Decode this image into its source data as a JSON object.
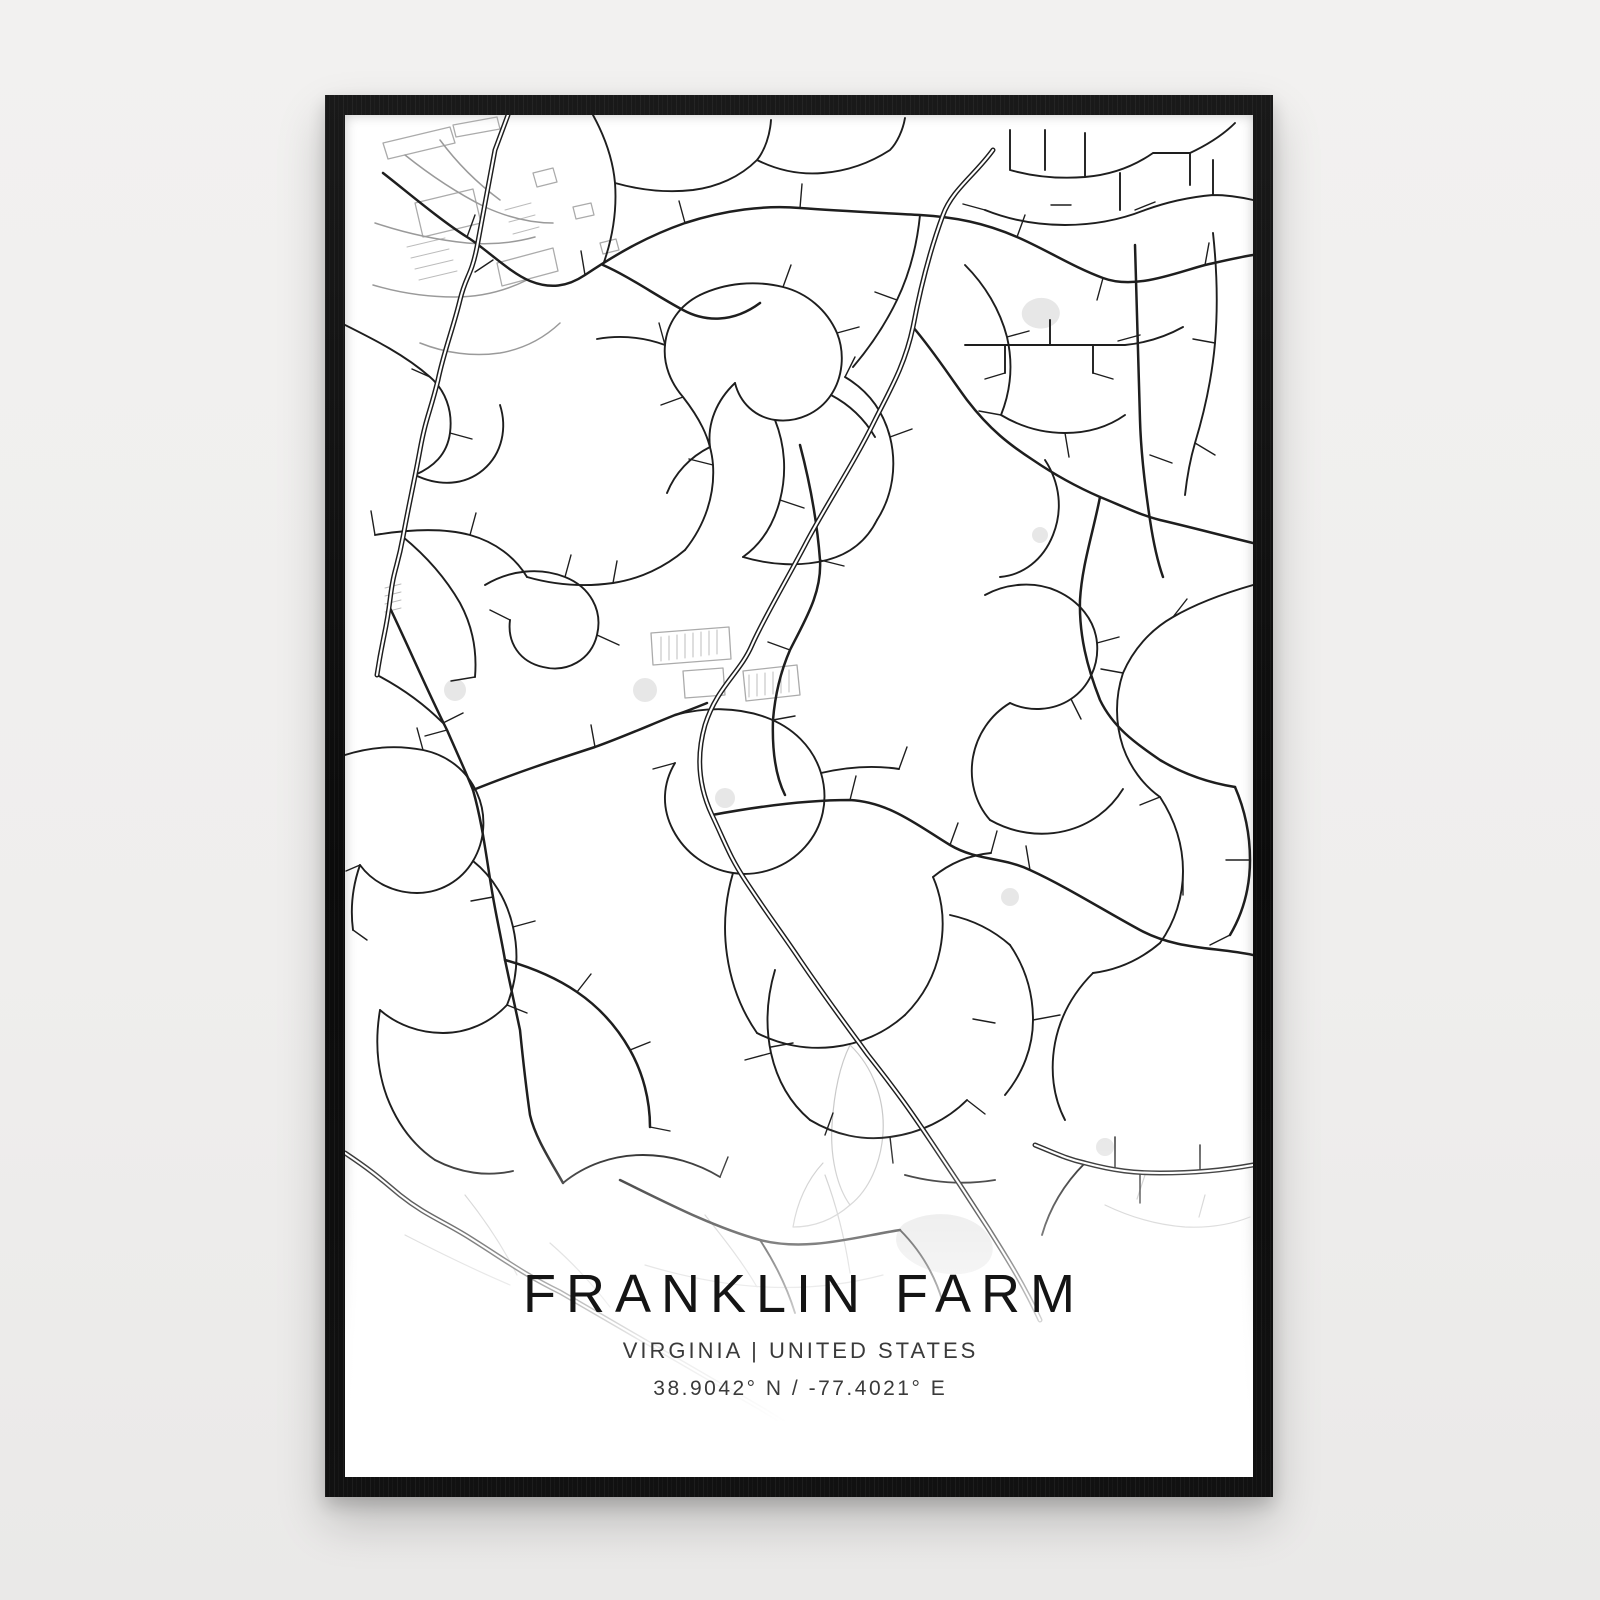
{
  "page": {
    "wall_color": "#f0efee"
  },
  "poster": {
    "title": "FRANKLIN FARM",
    "subtitle": "VIRGINIA | UNITED STATES",
    "coordinates": "38.9042° N / -77.4021° E",
    "frame_color": "#111111",
    "paper_color": "#ffffff"
  },
  "map": {
    "viewbox": "0 0 908 1362",
    "colors": {
      "road": "#1e1e1e",
      "casing_inner": "#ffffff",
      "commercial": "#9a9a9a",
      "building": "#ababab",
      "hatch": "#bcbcbc",
      "trail": "#c9c9c9",
      "pond": "#e7e7e7"
    },
    "major_roads": [
      "M648,35 C630,60 607,75 598,100 C585,135 575,175 568,212 C560,250 545,275 530,305 C508,350 478,395 460,430 C440,468 418,505 407,530 C395,558 372,572 360,610 C352,638 352,668 367,700 C382,732 385,742 400,765 C425,803 437,818 455,845 C487,892 505,915 523,940 C553,978 567,998 585,1025 C610,1062 625,1085 643,1113 C660,1140 678,1168 695,1205",
      "M163,0 L150,35 C144,66 138,100 132,132 C126,162 121,160 115,185 C108,214 99,236 93,265 C85,298 81,302 75,335 C69,368 64,389 58,422 C52,455 49,452 45,485 C41,518 38,520 32,560",
      "M0,1038 C30,1058 38,1066 55,1080 C80,1100 98,1106 125,1123 C160,1145 180,1160 215,1177 C250,1197 280,1215 315,1235 C350,1255 380,1273 415,1293 C437,1306 455,1318 478,1333",
      "M690,1030 C710,1038 722,1044 740,1048 C770,1056 790,1058 815,1058 C845,1058 875,1056 908,1050"
    ],
    "collector_roads": [
      "M38,58 C60,75 95,105 122,122 C140,133 165,158 185,166 C205,174 222,172 240,160 C270,140 300,122 340,108 C380,95 420,90 455,93 C495,96 540,98 575,100 C610,102 640,108 672,122 C700,134 728,152 758,163 C790,175 830,158 860,150 C878,146 895,142 908,140",
      "M568,212 C590,238 605,262 622,285 C645,315 665,330 688,345 C710,360 732,372 755,382 C775,390 795,400 815,405 C845,412 875,420 908,428",
      "M45,493 C65,535 82,575 102,615 C112,638 120,655 128,675 C138,710 142,748 148,782 C152,805 156,822 160,845 C165,868 170,892 175,915 C178,945 181,972 185,1000 C190,1022 205,1045 218,1068",
      "M128,675 C170,658 210,645 250,632 C278,622 305,610 330,600 C340,597 352,592 362,588",
      "M367,700 C410,692 460,685 505,685 C545,687 575,712 605,730 C632,746 658,742 685,755 C722,772 758,795 795,815 C832,835 870,832 908,840",
      "M455,330 C465,368 472,405 475,445 C477,478 460,505 445,535 C435,558 430,580 428,605 C427,635 430,660 440,680",
      "M755,382 C748,418 737,450 735,485 C734,520 742,552 755,585 C768,612 790,628 815,645 C840,660 865,668 890,672",
      "M790,130 C792,190 793,245 795,305 C796,340 800,372 805,405 C808,425 812,445 818,462",
      "M258,150 C285,162 310,180 338,195 C360,207 388,208 415,188",
      "M275,1065 C322,1088 368,1112 415,1125 C462,1137 510,1122 555,1115",
      "M160,845 C185,852 210,862 232,877 C254,892 272,912 285,935 C298,958 305,985 305,1012",
      "M890,672 C900,695 905,720 905,745 C905,772 898,798 885,820"
    ],
    "local_roads": [
      "M0,210 C30,225 60,240 85,262 C100,275 108,295 105,318 C102,340 88,352 70,360",
      "M70,360 C95,372 120,370 138,355 C158,338 162,312 155,290",
      "M30,420 C60,415 95,412 125,420 C150,427 170,442 182,462",
      "M58,422 C80,440 100,462 115,488 C128,512 132,538 130,562",
      "M140,470 C165,455 195,452 220,462 C245,472 258,495 252,520 C246,545 222,558 198,552 C175,547 162,528 165,505",
      "M182,462 C210,470 240,472 268,468 C295,464 320,452 340,435",
      "M340,435 C360,410 370,380 368,350 C366,322 352,300 338,282 C326,268 318,250 320,230 C322,208 335,190 355,180",
      "M355,180 C380,168 410,165 438,172 C462,178 482,195 492,218 C500,238 498,262 486,280 C474,298 452,308 430,305 C410,302 395,288 390,268",
      "M390,268 C372,285 362,308 365,332",
      "M430,305 C440,330 442,358 435,385 C428,412 415,430 398,442",
      "M398,442 C425,450 455,452 482,445 C505,439 522,425 532,405",
      "M532,405 C548,380 552,350 545,322 C538,295 522,275 500,262",
      "M320,230 C298,222 275,220 252,224 M486,280 C505,290 520,305 530,322 M365,332 C345,342 330,358 322,378",
      "M258,150 C268,122 272,95 270,68 C268,45 260,22 248,0 M270,68 C295,75 322,78 348,75 M348,75 C372,72 395,62 412,45 C420,35 425,20 426,5 M412,45 C432,55 455,60 478,58 M478,58 C502,56 525,48 545,35 C552,28 558,15 560,3",
      "M575,100 C572,130 565,158 552,185 C540,210 525,232 508,252",
      "M620,150 C640,170 655,195 662,222 M662,222 C668,248 666,275 656,300 M656,300 C676,312 698,318 720,318 M720,318 C742,318 763,312 780,300",
      "M665,15 L665,55 M665,55 C690,62 715,64 740,62 M740,62 L740,18 M740,62 C765,60 788,52 808,38 M700,55 L700,15 M775,58 L775,95 M808,38 L845,38 M845,38 L845,70 M845,38 C862,30 878,20 890,8",
      "M640,95 C665,105 692,110 720,110 C748,110 775,105 800,95 M800,95 C822,87 845,82 868,80 M868,80 L868,45 M868,80 C882,80 895,82 908,85",
      "M868,118 C872,155 873,192 870,228 C867,262 860,295 850,328 M850,328 C845,345 842,362 840,380",
      "M620,230 L780,230 M660,230 L660,258 M705,230 L705,205 M748,230 L748,258 M780,230 C800,228 820,222 838,212",
      "M700,345 C715,368 718,395 708,420 C698,445 678,460 655,462",
      "M908,470 C880,478 852,488 828,502 C805,515 788,535 778,558",
      "M778,558 C770,582 770,608 778,632 C785,652 798,670 815,682",
      "M640,480 C662,468 690,466 712,476 C734,486 750,505 752,528 C754,550 744,572 726,584 C708,596 684,597 665,588",
      "M665,588 C645,600 632,620 628,642 C624,665 630,688 645,705",
      "M645,705 C668,718 695,722 720,716 M720,716 C745,710 765,695 778,674",
      "M330,600 C360,592 392,592 420,602 C448,612 468,632 476,658 C484,685 478,712 460,732 C442,752 415,762 388,758 C362,754 340,738 328,715 C316,692 318,668 330,648",
      "M476,658 C502,652 528,650 554,654",
      "M388,758 C380,785 378,812 382,840 C386,868 396,895 412,918",
      "M412,918 C435,930 462,935 488,932 C515,929 540,918 560,900",
      "M560,900 C578,882 590,860 595,835 C600,810 598,785 588,762",
      "M588,762 C605,748 625,740 646,738",
      "M32,560 C55,572 78,588 98,608",
      "M0,640 C25,632 52,630 78,635 C102,640 122,655 132,678 C142,700 140,726 128,746 C116,766 95,778 72,778 C50,778 28,768 15,750",
      "M15,750 C8,770 5,792 8,815",
      "M128,746 C148,762 162,785 168,812 C174,838 172,865 162,890",
      "M162,890 C145,908 122,918 98,918 C75,918 52,910 35,895",
      "M35,895 C30,925 32,955 42,982 C52,1008 68,1030 90,1045",
      "M90,1045 C115,1058 142,1062 168,1056",
      "M218,1068 C240,1050 268,1040 298,1040",
      "M298,1040 C325,1040 352,1048 375,1062",
      "M430,855 C422,882 420,910 426,938 C432,965 445,988 465,1005",
      "M465,1005 C490,1020 518,1026 545,1022",
      "M545,1022 C575,1018 602,1005 622,985",
      "M660,980 C678,958 688,932 688,905 C688,878 680,852 665,830",
      "M665,830 C648,815 628,805 605,800",
      "M740,1048 C720,1068 705,1092 697,1120",
      "M815,682 C830,705 838,730 838,756 C838,782 830,807 815,828",
      "M815,828 C795,845 772,855 748,858",
      "M748,858 C728,878 715,902 710,928 C705,955 708,982 720,1005",
      "M560,1060 C590,1068 620,1070 650,1065 M415,1125 C430,1148 442,1172 450,1198 M555,1115 C575,1135 590,1160 598,1188"
    ],
    "stub_roads": [
      "M85,262 l-18,-8 M105,318 l22,6 M130,562 l-24,4 M165,505 l-20,-10 M252,520 l22,10 M220,462 l6,-22 M268,468 l4,-22 M30,420 l-4,-24 M125,420 l6,-22",
      "M368,350 l-24,-6 M338,282 l-22,8 M438,172 l8,-22 M492,218 l22,-6 M435,385 l24,8 M500,262 l10,-20 M545,322 l22,-8 M552,185 l-22,-8 M320,230 l-6,-22",
      "M726,90 l-20,0 M790,95 l20,-8 M795,220 l-22,6 M805,340 l22,8 M850,328 l20,12 M660,258 l-20,6 M748,258 l20,6 M870,228 l-22,-4 M640,95 l-22,-6",
      "M475,445 l24,6 M445,535 l-22,-8 M505,685 l6,-24 M605,730 l8,-22 M685,755 l-4,-24 M330,648 l-22,6 M554,654 l8,-22 M646,738 l6,-22",
      "M78,635 l-6,-22 M15,750 l-14,6 M168,812 l22,-6 M98,608 l20,-10 M8,815 l14,10 M162,890 l20,8",
      "M232,877 l14,-18 M285,935 l20,-8 M305,1012 l20,4 M375,1062 l8,-20 M448,928 l-22,4 M488,998 l-8,22 M622,985 l18,14 M650,908 l-22,-4",
      "M828,502 l14,-18 M778,558 l-22,-4 M838,756 l0,24 M885,820 l-20,10 M905,745 l-24,0 M815,682 l-20,8 M752,528 l22,-6 M726,584 l10,20",
      "M122,122 l8,-22 M240,160 l-4,-24 M340,108 l-6,-22 M455,93 l2,-24 M672,122 l8,-22 M758,163 l-6,22 M860,150 l4,-22 M148,145 l-18,12 M102,615 l-22,6 M148,782 l-22,4 M250,632 l-4,-22 M428,605 l22,-4",
      "M795,1057 l0,31 M855,1057 l0,-27 M770,1052 l0,-30 M662,222 l22,-6 M656,300 l-22,-4 M720,318 l4,24 M426,938 l-26,7 M545,1022 l3,26 M688,905 l27,-5"
    ],
    "commercial_roads": [
      "M30,108 C60,118 92,125 122,128 C145,130 168,128 190,122",
      "M60,40 C85,60 112,78 140,92 M140,92 C162,102 185,108 208,108 M95,25 C112,48 132,68 155,85",
      "M28,170 C55,178 82,182 110,182 M110,182 C135,182 160,176 182,165",
      "M75,228 C100,238 128,242 155,238 M155,238 C178,234 198,224 215,208"
    ],
    "buildings": [
      "M38,28 L105,12 L110,28 L43,44 Z",
      "M108,10 L152,2 L155,14 L111,22 Z",
      "M70,88 L128,74 L136,108 L78,122 Z",
      "M152,148 L208,133 L213,156 L157,171 Z",
      "M188,58 l20,-5 l4,14 l-20,5 Z M228,92 l18,-4 l3,12 l-18,4 Z M255,128 l16,-4 l3,11 l-16,4 Z",
      "M306,518 L384,512 L386,544 L308,550 Z M338,556 L378,553 L380,580 L340,583 Z",
      "M398,556 L452,550 L455,580 L401,586 Z"
    ],
    "building_hatches": [
      "M62,132 l38,-9 M66,143 l38,-9 M70,154 l38,-9 M74,165 l38,-9",
      "M316,522 l0,24 M324,521 l0,24 M332,520 l0,24 M340,519 l0,24 M348,518 l0,24 M356,517 l0,24 M364,516 l0,24 M372,515 l0,24",
      "M404,560 l0,22 M412,559 l0,22 M420,558 l0,22 M428,557 l0,22 M436,556 l0,22 M444,555 l0,22",
      "M160,95 l26,-7 M164,107 l26,-7 M168,119 l26,-7 M40,473 l16,-4 M40,481 l16,-4 M40,489 l16,-4 M40,497 l16,-4"
    ],
    "trails": [
      "M505,930 C528,952 540,985 538,1018 C536,1048 524,1075 505,1090 C492,1072 485,1042 487,1010 C489,978 495,950 505,930",
      "M505,1090 C488,1105 468,1112 448,1112 C452,1088 462,1065 478,1048",
      "M300,1150 C340,1162 380,1170 420,1172 M420,1172 C460,1174 500,1170 538,1160 M360,1100 C380,1125 398,1148 412,1172 M480,1060 C492,1092 500,1125 505,1158",
      "M60,1120 C95,1138 130,1155 165,1170 M120,1080 C140,1105 158,1132 172,1160 M205,1128 C228,1148 248,1170 265,1192",
      "M760,1090 C785,1102 812,1110 840,1112 M840,1112 C862,1113 885,1110 905,1102 M800,1060 l-8,24 M860,1080 l-6,22"
    ],
    "ponds": [
      "M682,188 c10,-8 24,-6 30,2 c6,8 2,18 -8,22 c-10,4 -22,0 -26,-8 c-3,-7 0,-12 4,-16",
      "M99,575 a11,11 0 1,0 22,0 a11,11 0 1,0 -22,0",
      "M288,575 a12,12 0 1,0 24,0 a12,12 0 1,0 -24,0",
      "M560,1108 c18,-10 42,-12 62,-4 c20,8 30,24 24,38 c-6,14 -28,20 -50,16 c-22,-4 -40,-16 -44,-28 c-3,-10 2,-18 8,-22",
      "M751,1032 a9,9 0 1,0 18,0 a9,9 0 1,0 -18,0",
      "M687,420 a8,8 0 1,0 16,0 a8,8 0 1,0 -16,0",
      "M370,683 a10,10 0 1,0 20,0 a10,10 0 1,0 -20,0",
      "M656,782 a9,9 0 1,0 18,0 a9,9 0 1,0 -18,0"
    ]
  }
}
